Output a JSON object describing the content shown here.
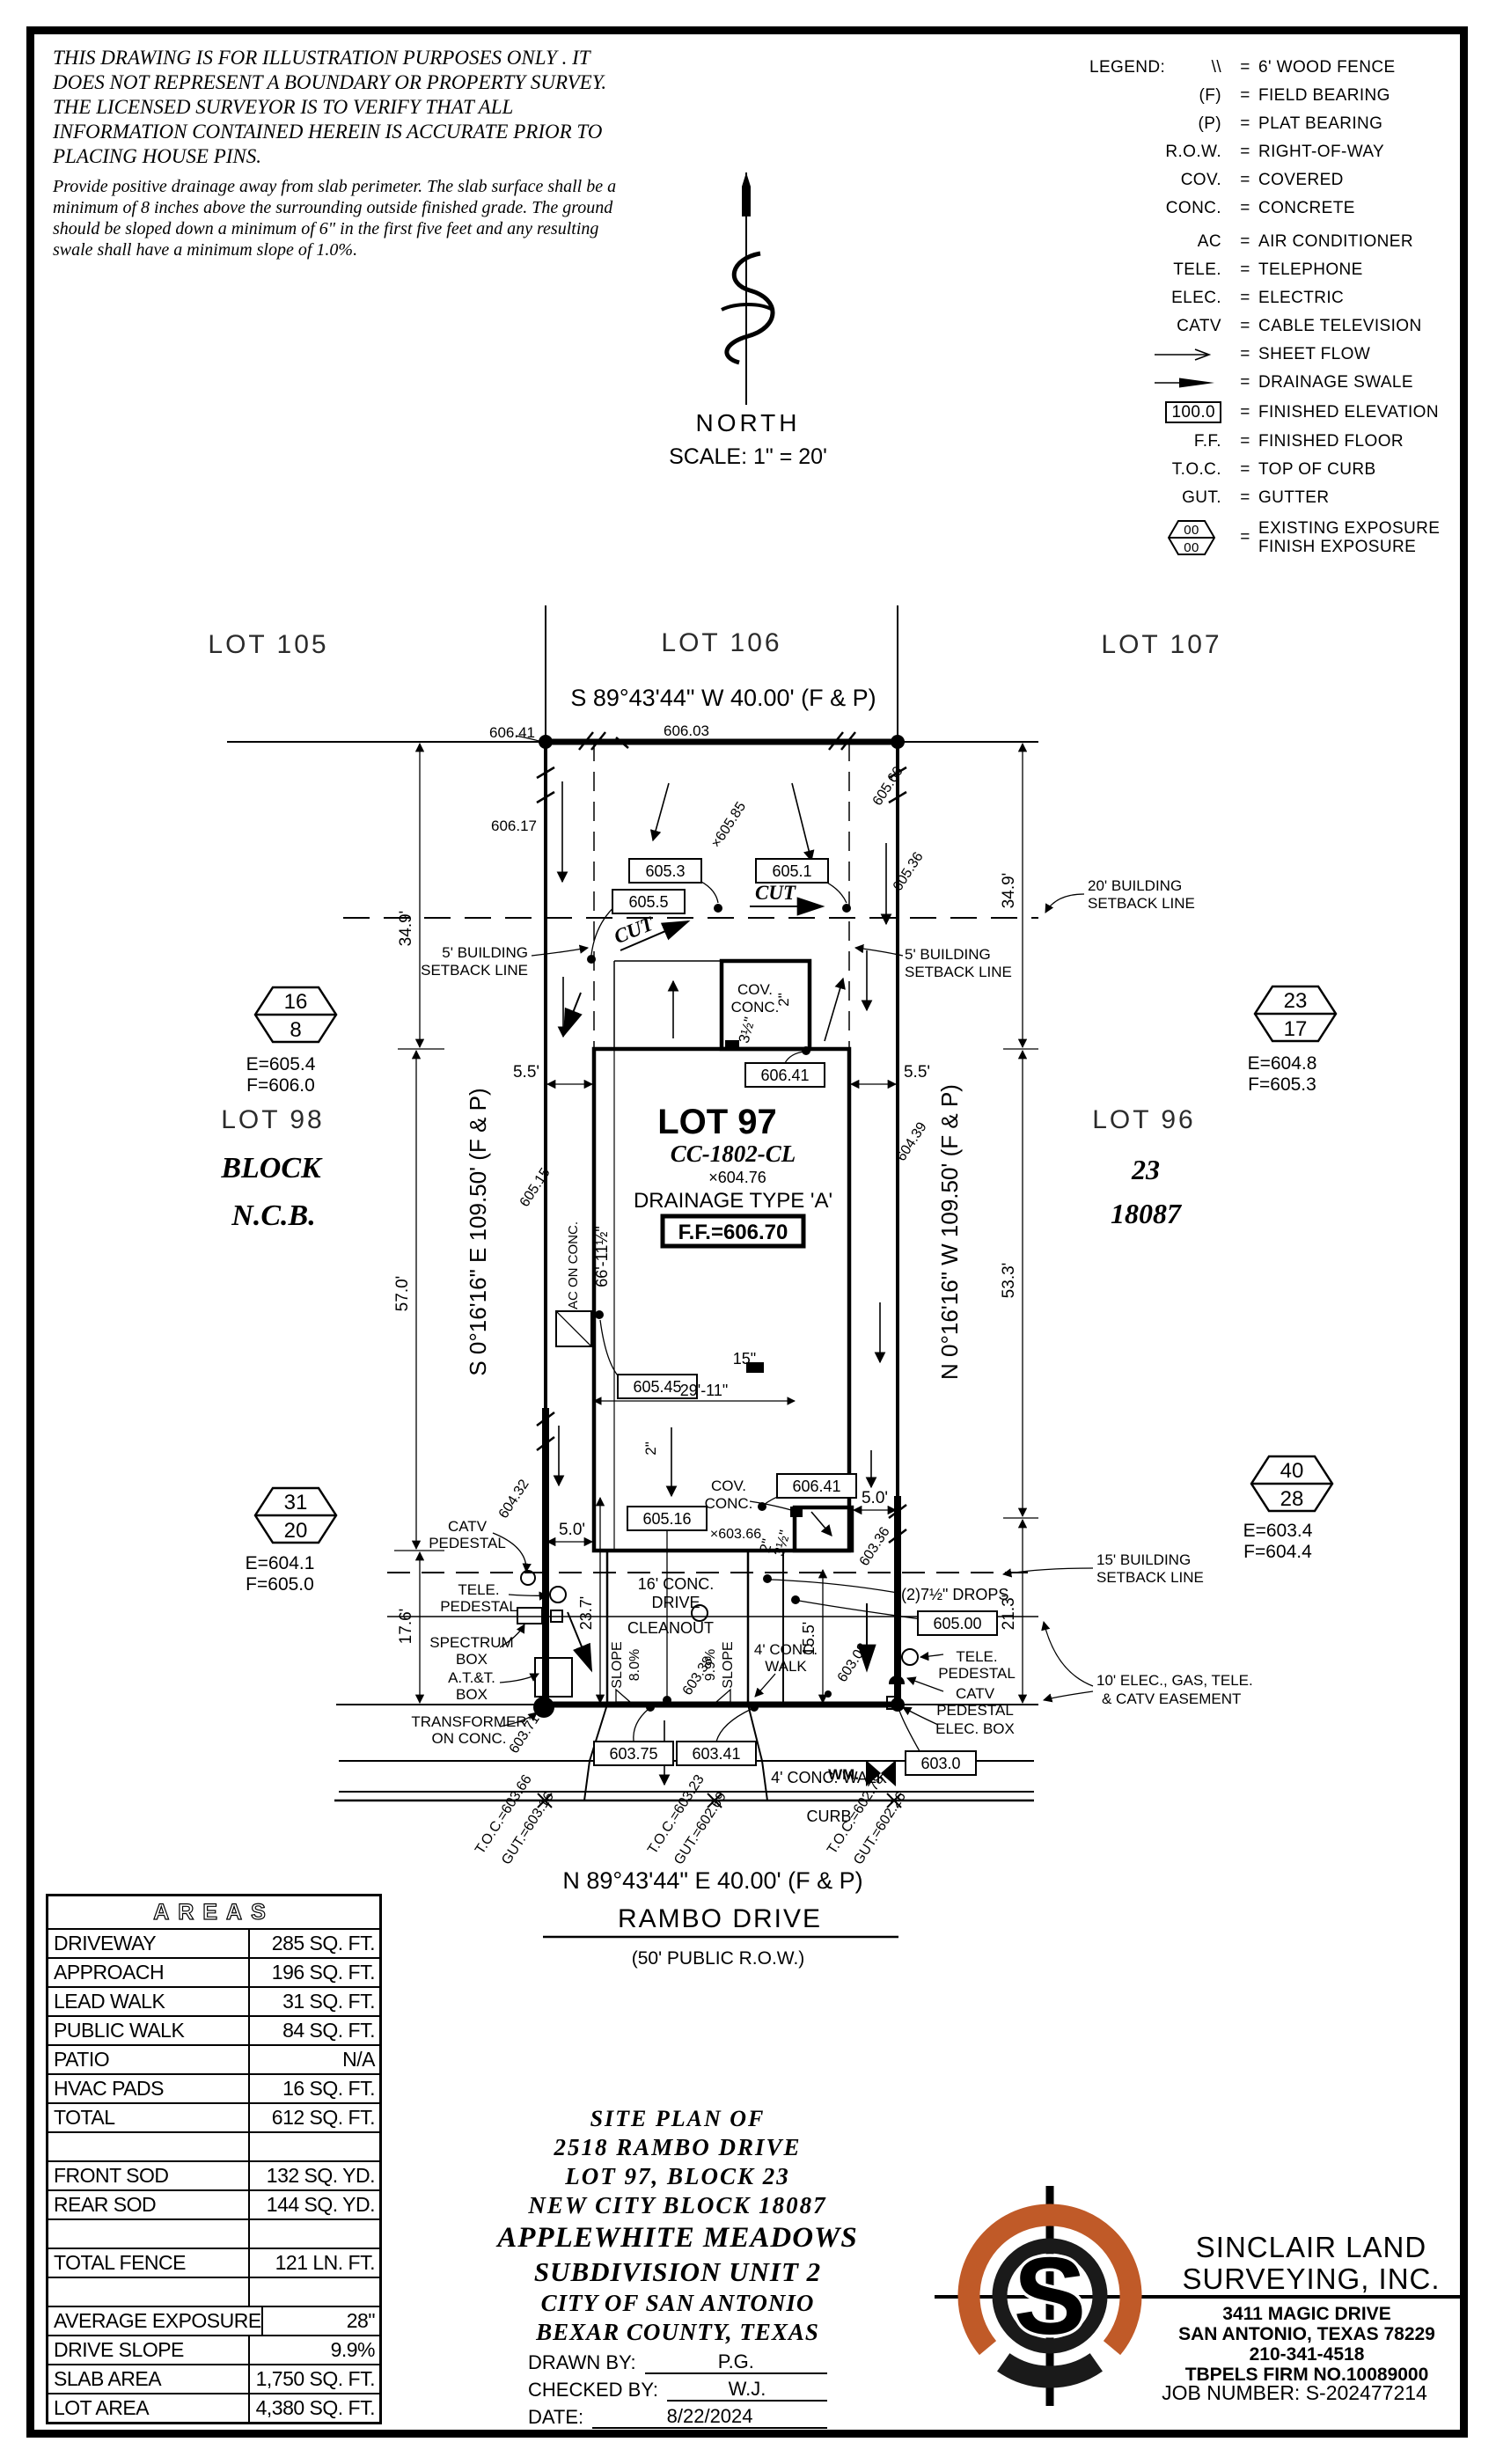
{
  "disclaimer": {
    "p1": "THIS DRAWING IS FOR ILLUSTRATION PURPOSES ONLY . IT DOES NOT REPRESENT A BOUNDARY OR PROPERTY SURVEY. THE LICENSED SURVEYOR IS TO VERIFY THAT ALL INFORMATION CONTAINED HEREIN IS ACCURATE PRIOR TO PLACING HOUSE PINS.",
    "p2": "Provide positive drainage away from slab perimeter. The slab surface shall be a minimum of 8 inches above the surrounding outside finished grade. The ground should be sloped down a minimum of 6\" in the first five feet and any resulting swale shall have a minimum slope of 1.0%."
  },
  "legend": {
    "title": "LEGEND:",
    "eq": "=",
    "rows": [
      {
        "sym": "\\\\",
        "desc": "6' WOOD FENCE"
      },
      {
        "sym": "(F)",
        "desc": "FIELD BEARING"
      },
      {
        "sym": "(P)",
        "desc": "PLAT BEARING"
      },
      {
        "sym": "R.O.W.",
        "desc": "RIGHT-OF-WAY"
      },
      {
        "sym": "COV.",
        "desc": "COVERED"
      },
      {
        "sym": "CONC.",
        "desc": "CONCRETE"
      },
      {
        "sym": "AC",
        "desc": "AIR CONDITIONER"
      },
      {
        "sym": "TELE.",
        "desc": "TELEPHONE"
      },
      {
        "sym": "ELEC.",
        "desc": "ELECTRIC"
      },
      {
        "sym": "CATV",
        "desc": "CABLE TELEVISION"
      }
    ],
    "sheet_flow": "SHEET FLOW",
    "swale": "DRAINAGE SWALE",
    "fin_elev_sym": "100.0",
    "fin_elev": "FINISHED ELEVATION",
    "ff_sym": "F.F.",
    "ff": "FINISHED FLOOR",
    "toc_sym": "T.O.C.",
    "toc": "TOP OF CURB",
    "gut_sym": "GUT.",
    "gut": "GUTTER",
    "hex_top": "00",
    "hex_bot": "00",
    "exp1": "EXISTING EXPOSURE",
    "exp2": "FINISH EXPOSURE"
  },
  "north": {
    "label": "NORTH",
    "scale": "SCALE:  1\" = 20'"
  },
  "plan": {
    "lot105": "LOT 105",
    "lot106": "LOT 106",
    "lot107": "LOT 107",
    "brgTop": "S 89°43'44\" W  40.00'  (F & P)",
    "brgBottom": "N 89°43'44\" E  40.00'  (F & P)",
    "brgLeft": "S 0°16'16\" E  109.50'  (F & P)",
    "brgRight": "N 0°16'16\" W  109.50'  (F & P)",
    "street": "RAMBO DRIVE",
    "prow": "(50' PUBLIC R.O.W.)",
    "lot98": "LOT 98",
    "block": "BLOCK",
    "ncb": "N.C.B.",
    "lot96": "LOT 96",
    "blk23": "23",
    "ncb18087": "18087",
    "lot97": "LOT 97",
    "model": "CC-1802-CL",
    "pad": "×604.76",
    "drainage": "DRAINAGE  TYPE  'A'",
    "ff": "F.F.=606.70",
    "hexA_top": "16",
    "hexA_bot": "8",
    "hexA_e": "E=605.4",
    "hexA_f": "F=606.0",
    "hexB_top": "23",
    "hexB_bot": "17",
    "hexB_e": "E=604.8",
    "hexB_f": "F=605.3",
    "hexC_top": "31",
    "hexC_bot": "20",
    "hexC_e": "E=604.1",
    "hexC_f": "F=605.0",
    "hexD_top": "40",
    "hexD_bot": "28",
    "hexD_e": "E=603.4",
    "hexD_f": "F=604.4",
    "b605_3": "605.3",
    "b605_5": "605.5",
    "b605_1": "605.1",
    "b606_41a": "606.41",
    "b605_45": "605.45",
    "b605_16": "605.16",
    "b606_41b": "606.41",
    "b605_00": "605.00",
    "b603_75": "603.75",
    "b603_41": "603.41",
    "b603_0": "603.0",
    "e606_41": "606.41",
    "e606_03": "606.03",
    "e606_17": "606.17",
    "e605_85": "×605.85",
    "e605_66": "605.66",
    "e605_36": "605.36",
    "e605_15": "605.15",
    "e604_39": "604.39",
    "e604_32": "604.32",
    "e603_36": "603.36",
    "e603_66": "×603.66",
    "e603_08": "603.08",
    "e603_71": "603.71",
    "e603_38": "603.38",
    "cut": "CUT",
    "sb5a": "5' BUILDING",
    "sb5b": "SETBACK LINE",
    "sb20a": "20' BUILDING",
    "sb20b": "SETBACK LINE",
    "sb15a": "15' BUILDING",
    "sb15b": "SETBACK LINE",
    "esmt1": "10' ELEC., GAS, TELE.",
    "esmt2": "& CATV EASEMENT",
    "d34_9": "34.9'",
    "d57": "57.0'",
    "d17_6": "17.6'",
    "d53_3": "53.3'",
    "d21_3": "21.3'",
    "d5_5": "5.5'",
    "d5_0": "5.0'",
    "d15_5": "15.5'",
    "d23_7": "23.7'",
    "d66": "66'-11½\"",
    "d29": "29'-11\"",
    "d15in": "15\"",
    "d2": "2\"",
    "d3_5": "3½\"",
    "covconc1": "COV.",
    "covconc2": "CONC.",
    "catv1": "CATV",
    "catv2": "PEDESTAL",
    "tele1": "TELE.",
    "tele2": "PEDESTAL",
    "spec1": "SPECTRUM",
    "spec2": "BOX",
    "att1": "A.T.&T.",
    "att2": "BOX",
    "xfmr1": "TRANSFORMER",
    "xfmr2": "ON CONC.",
    "elec": "ELEC. BOX",
    "drops": "(2)7½\" DROPS",
    "drive1": "16' CONC.",
    "drive2": "DRIVE",
    "cleanout": "CLEANOUT",
    "slope": "SLOPE",
    "s8": "8.0%",
    "s9": "9.9%",
    "walk1": "4' CONC.",
    "walk2": "WALK",
    "walkB": "4' CONC. WALK",
    "curb": "CURB",
    "wm": "WM.",
    "ac": "AC ON CONC.",
    "toc1a": "T.O.C.=603.66",
    "toc1b": "GUT.=603.16",
    "toc2a": "T.O.C.=603.23",
    "toc2b": "GUT.=602.69",
    "toc3a": "T.O.C.=602.78",
    "toc3b": "GUT.=602.26"
  },
  "areas": {
    "title": "AREAS",
    "rows": [
      {
        "label": "DRIVEWAY",
        "value": "285 SQ. FT."
      },
      {
        "label": "APPROACH",
        "value": "196 SQ. FT."
      },
      {
        "label": "LEAD WALK",
        "value": "31 SQ. FT."
      },
      {
        "label": "PUBLIC WALK",
        "value": "84 SQ. FT."
      },
      {
        "label": "PATIO",
        "value": "N/A"
      },
      {
        "label": "HVAC PADS",
        "value": "16 SQ. FT."
      },
      {
        "label": "TOTAL",
        "value": "612 SQ. FT."
      },
      {
        "label": "",
        "value": ""
      },
      {
        "label": "FRONT SOD",
        "value": "132 SQ. YD."
      },
      {
        "label": "REAR SOD",
        "value": "144 SQ. YD."
      },
      {
        "label": "",
        "value": ""
      },
      {
        "label": "TOTAL FENCE",
        "value": "121 LN. FT."
      },
      {
        "label": "",
        "value": ""
      },
      {
        "label": "AVERAGE EXPOSURE",
        "value": "28\""
      },
      {
        "label": "DRIVE SLOPE",
        "value": "9.9%"
      },
      {
        "label": "SLAB AREA",
        "value": "1,750 SQ. FT."
      },
      {
        "label": "LOT AREA",
        "value": "4,380 SQ. FT."
      }
    ]
  },
  "titleblock": {
    "l1": "SITE PLAN OF",
    "l2": "2518 RAMBO DRIVE",
    "l3": "LOT 97, BLOCK 23",
    "l4": "NEW CITY BLOCK 18087",
    "l5": "APPLEWHITE MEADOWS",
    "l6": "SUBDIVISION UNIT 2",
    "l7": "CITY OF SAN ANTONIO",
    "l8": "BEXAR COUNTY, TEXAS",
    "drawn_label": "DRAWN BY:",
    "drawn": "P.G.",
    "checked_label": "CHECKED BY:",
    "checked": "W.J.",
    "date_label": "DATE:",
    "date": "8/22/2024"
  },
  "firm": {
    "name1": "SINCLAIR LAND",
    "name2": "SURVEYING, INC.",
    "addr1": "3411 MAGIC DRIVE",
    "addr2": "SAN ANTONIO, TEXAS 78229",
    "phone": "210-341-4518",
    "reg": "TBPELS FIRM NO.10089000",
    "job": "JOB NUMBER:  S-202477214",
    "letter": "S"
  },
  "colors": {
    "accent": "#C05A28",
    "ink": "#000000"
  }
}
